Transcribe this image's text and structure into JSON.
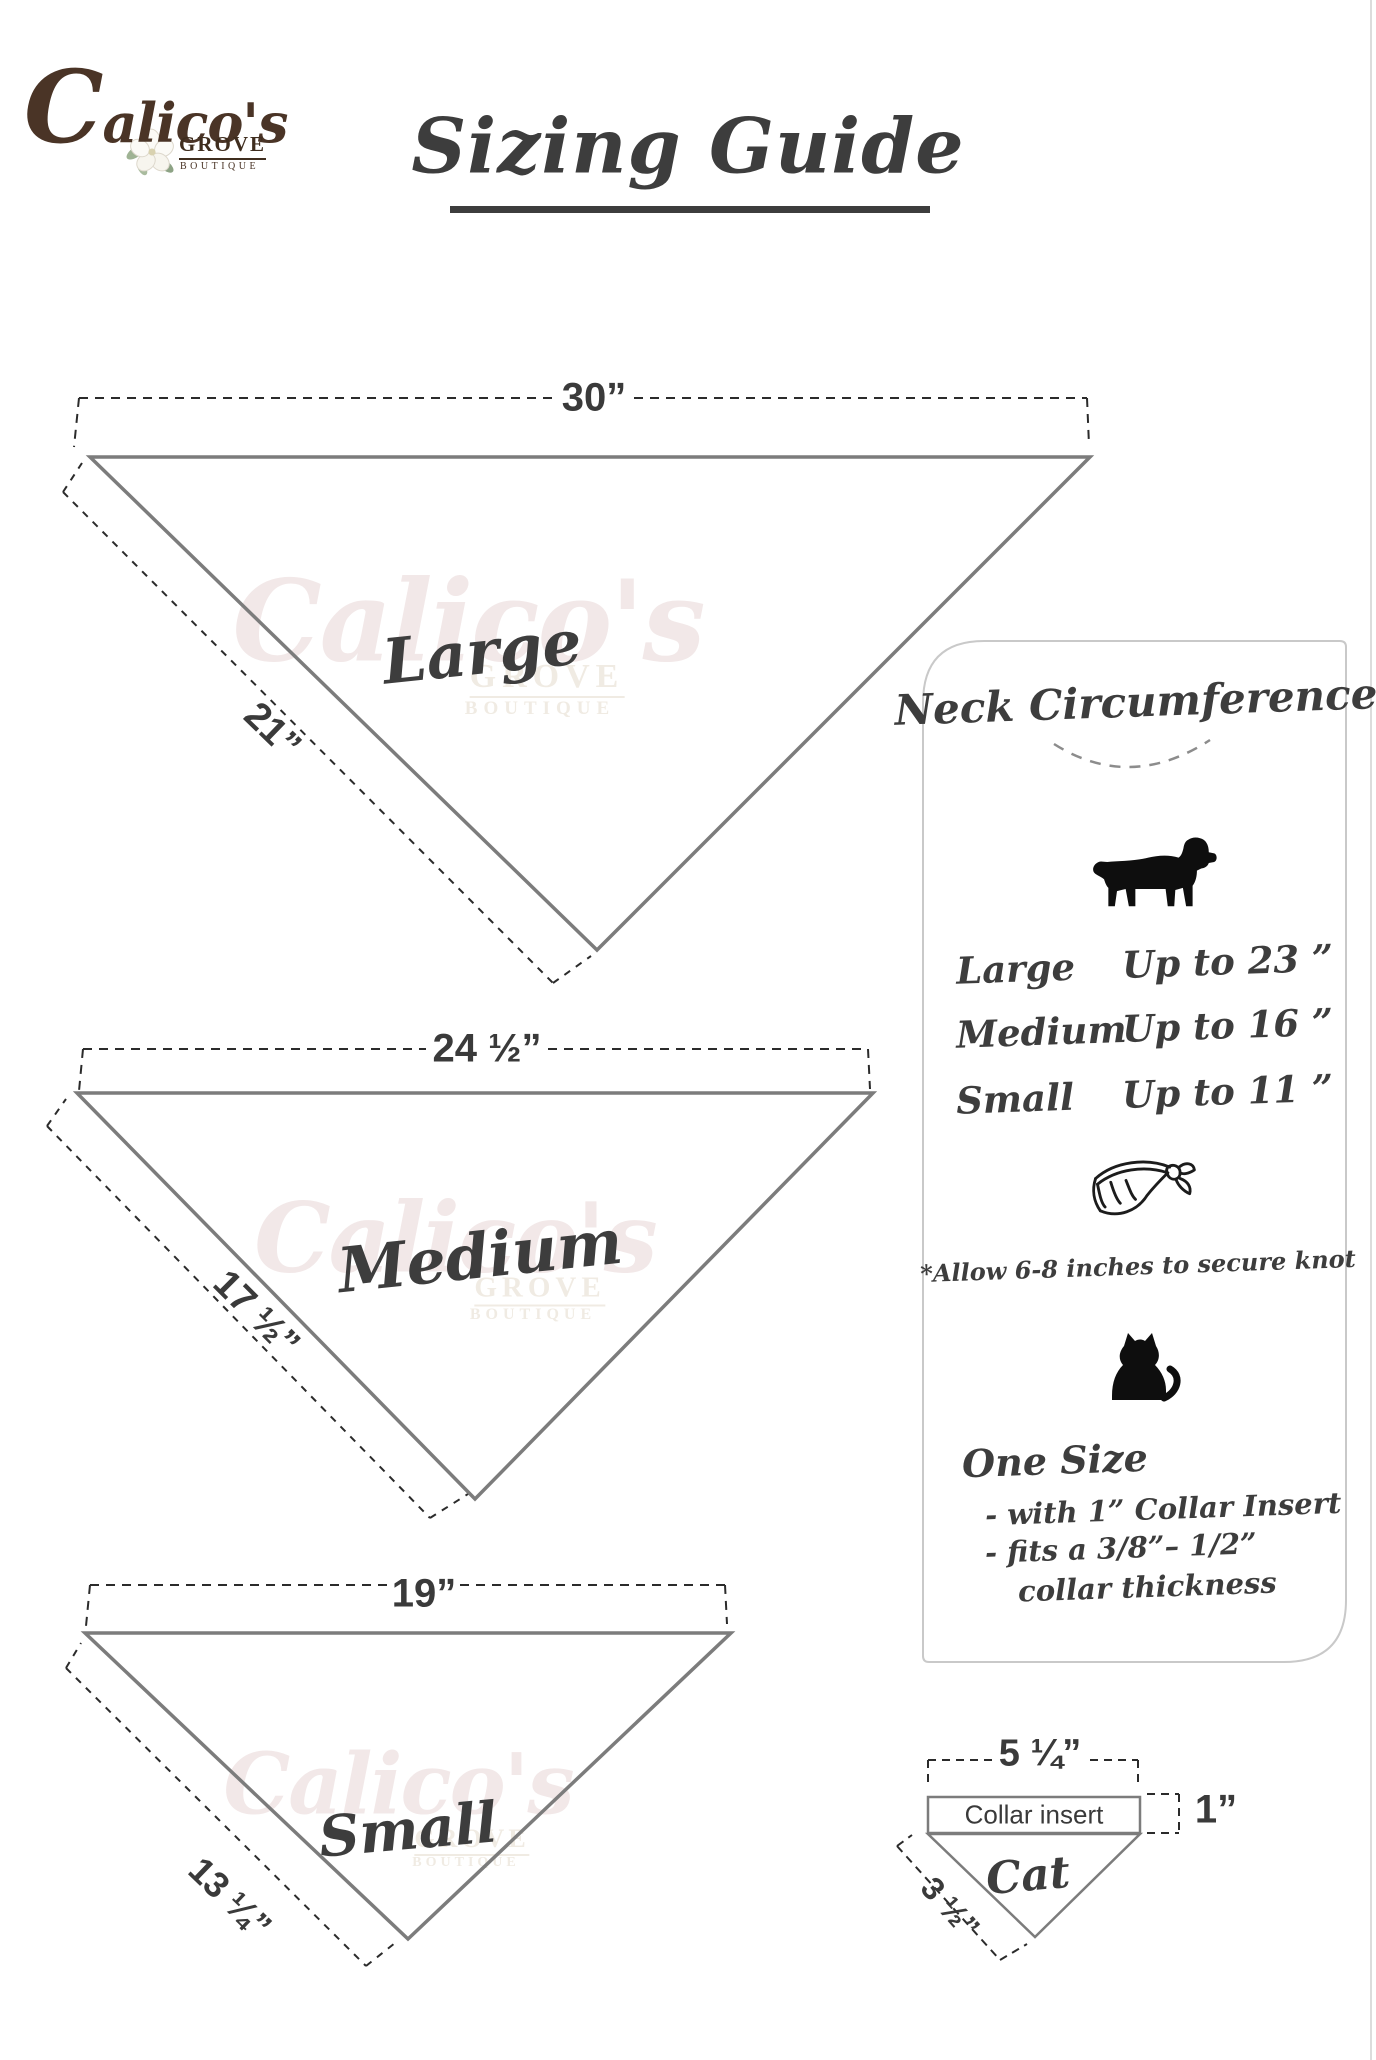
{
  "logo": {
    "name": "Calico's",
    "grove": "GROVE",
    "boutique": "BOUTIQUE"
  },
  "title": "Sizing Guide",
  "watermark": {
    "script": "Calico's",
    "grove": "GROVE",
    "boutique": "BOUTIQUE"
  },
  "bandanas": {
    "large": {
      "label": "Large",
      "top_width": "30”",
      "side_length": "21”"
    },
    "medium": {
      "label": "Medium",
      "top_width": "24 ½”",
      "side_length": "17 ½”"
    },
    "small": {
      "label": "Small",
      "top_width": "19”",
      "side_length": "13 ¼”"
    }
  },
  "panel": {
    "title": "Neck Circumference",
    "rows": [
      {
        "size": "Large",
        "value": "Up to 23 ”"
      },
      {
        "size": "Medium",
        "value": "Up to 16 ”"
      },
      {
        "size": "Small",
        "value": "Up to 11 ”"
      }
    ],
    "knot_note": "*Allow 6-8 inches to secure knot",
    "one_size": {
      "heading": "One Size",
      "line1": "- with 1” Collar Insert",
      "line2": "- fits a 3/8”– 1/2”",
      "line3": "collar thickness"
    }
  },
  "cat_diagram": {
    "top_width": "5 ¼”",
    "insert_label": "Collar insert",
    "insert_height": "1”",
    "side_length": "3 ½”",
    "label": "Cat"
  },
  "icons": {
    "dog": "dog-icon",
    "bandana": "bandana-knot-icon",
    "cat": "cat-icon",
    "flower": "flower-icon"
  },
  "colors": {
    "triangle_stroke": "#7c7c7c",
    "dash": "#2b2b2b",
    "text": "#3d3d3d",
    "panel_border": "#c9c9c9",
    "logo_brown": "#4a3426",
    "watermark_pink": "#f2e8e8",
    "icon_black": "#0e0e0e"
  }
}
